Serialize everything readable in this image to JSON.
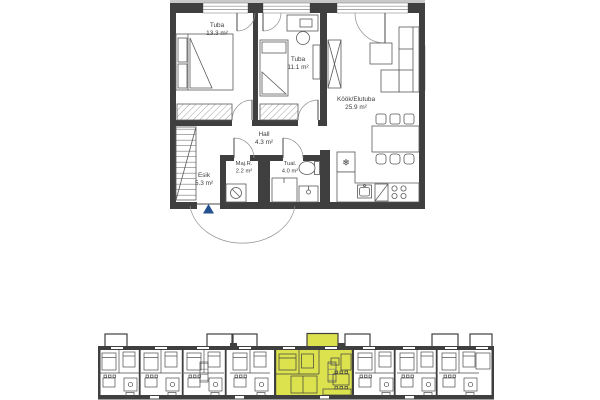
{
  "floor_plan": {
    "rooms": [
      {
        "name": "Tuba",
        "area": "13.3 m²"
      },
      {
        "name": "Tuba",
        "area": "11.1 m²"
      },
      {
        "name": "Köök/Elutuba",
        "area": "25.9 m²"
      },
      {
        "name": "Hall",
        "area": "4.3 m²"
      },
      {
        "name": "Esik",
        "area": "5.3 m²"
      },
      {
        "name": "Maj.R.",
        "area": "2.2 m²"
      },
      {
        "name": "Tual.",
        "area": "4.0 m²"
      }
    ],
    "fridge_icon": "❄",
    "colors": {
      "wall": "#3f3f3f",
      "entrance_marker": "#23508e",
      "highlight": "#dce24e"
    }
  },
  "site_plan": {
    "highlight_color": "#dce24e"
  }
}
